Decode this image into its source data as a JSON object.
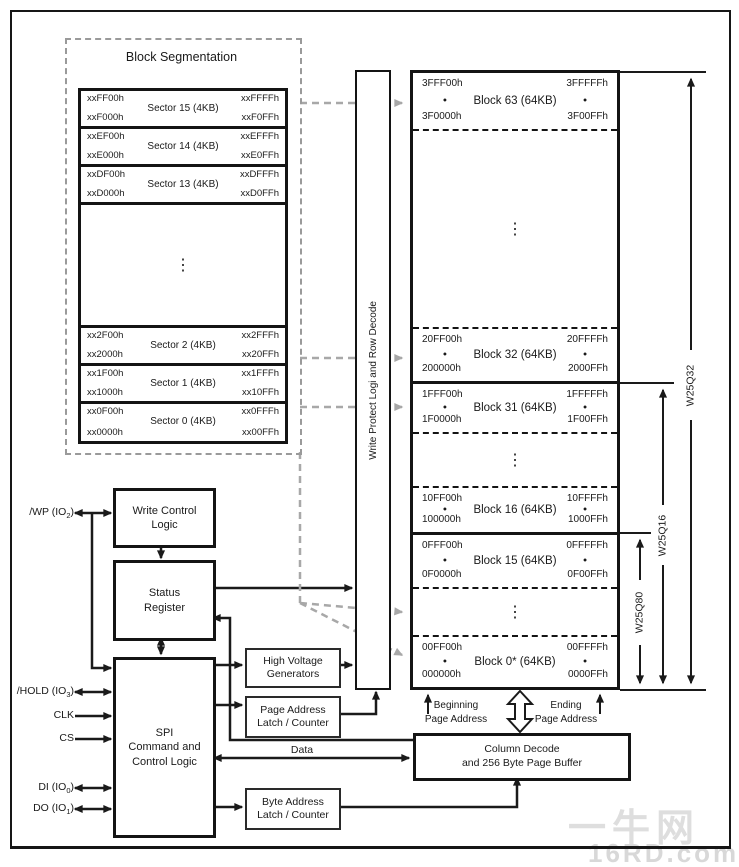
{
  "block_segmentation": {
    "title": "Block Segmentation",
    "ellipsis": "⋮",
    "sectors": [
      {
        "name": "Sector 15 (4KB)",
        "tl": "xxFF00h",
        "tr": "xxFFFFh",
        "bl": "xxF000h",
        "br": "xxF0FFh"
      },
      {
        "name": "Sector 14 (4KB)",
        "tl": "xxEF00h",
        "tr": "xxEFFFh",
        "bl": "xxE000h",
        "br": "xxE0FFh"
      },
      {
        "name": "Sector 13 (4KB)",
        "tl": "xxDF00h",
        "tr": "xxDFFFh",
        "bl": "xxD000h",
        "br": "xxD0FFh"
      },
      {
        "name": "Sector 2 (4KB)",
        "tl": "xx2F00h",
        "tr": "xx2FFFh",
        "bl": "xx2000h",
        "br": "xx20FFh"
      },
      {
        "name": "Sector 1 (4KB)",
        "tl": "xx1F00h",
        "tr": "xx1FFFh",
        "bl": "xx1000h",
        "br": "xx10FFh"
      },
      {
        "name": "Sector 0 (4KB)",
        "tl": "xx0F00h",
        "tr": "xx0FFFh",
        "bl": "xx0000h",
        "br": "xx00FFh"
      }
    ]
  },
  "write_protect_bar": {
    "label": "Write Protect Logi and Row Decode"
  },
  "memory_array": {
    "ellipsis": "⋮",
    "page_dot": "•",
    "blocks": [
      {
        "name": "Block 63 (64KB)",
        "tl": "3FFF00h",
        "tr": "3FFFFFh",
        "bl": "3F0000h",
        "br": "3F00FFh"
      },
      {
        "name": "Block 32 (64KB)",
        "tl": "20FF00h",
        "tr": "20FFFFh",
        "bl": "200000h",
        "br": "2000FFh"
      },
      {
        "name": "Block 31 (64KB)",
        "tl": "1FFF00h",
        "tr": "1FFFFFh",
        "bl": "1F0000h",
        "br": "1F00FFh"
      },
      {
        "name": "Block 16 (64KB)",
        "tl": "10FF00h",
        "tr": "10FFFFh",
        "bl": "100000h",
        "br": "1000FFh"
      },
      {
        "name": "Block 15 (64KB)",
        "tl": "0FFF00h",
        "tr": "0FFFFFh",
        "bl": "0F0000h",
        "br": "0F00FFh"
      },
      {
        "name": "Block 0* (64KB)",
        "tl": "00FF00h",
        "tr": "00FFFFh",
        "bl": "000000h",
        "br": "0000FFh"
      }
    ]
  },
  "control_boxes": {
    "write_control": "Write Control\nLogic",
    "status_register": "Status\nRegister",
    "spi": "SPI\nCommand and\nControl Logic",
    "high_voltage": "High Voltage\nGenerators",
    "page_address": "Page Address\nLatch / Counter",
    "byte_address": "Byte Address\nLatch / Counter",
    "column_decode": "Column Decode\nand 256 Byte Page Buffer"
  },
  "signals": [
    {
      "pre": "/WP (IO",
      "sub": "2",
      "post": ")"
    },
    {
      "pre": "/HOLD (IO",
      "sub": "3",
      "post": ")"
    },
    {
      "pre": "CLK",
      "sub": "",
      "post": ""
    },
    {
      "pre": "CS",
      "sub": "",
      "post": ""
    },
    {
      "pre": "DI (IO",
      "sub": "0",
      "post": ")"
    },
    {
      "pre": "DO (IO",
      "sub": "1",
      "post": ")"
    }
  ],
  "annotations": {
    "beginning_page": "Beginning\nPage Address",
    "ending_page": "Ending\nPage Address",
    "data_label": "Data"
  },
  "device_braces": [
    {
      "label": "W25Q32"
    },
    {
      "label": "W25Q16"
    },
    {
      "label": "W25Q80"
    }
  ],
  "watermark": {
    "line1": "一牛网",
    "line2": "16RD.com"
  },
  "colors": {
    "line": "#1a1a1a",
    "dashed_gray": "#a8a8a8",
    "watermark": "#dedede"
  }
}
